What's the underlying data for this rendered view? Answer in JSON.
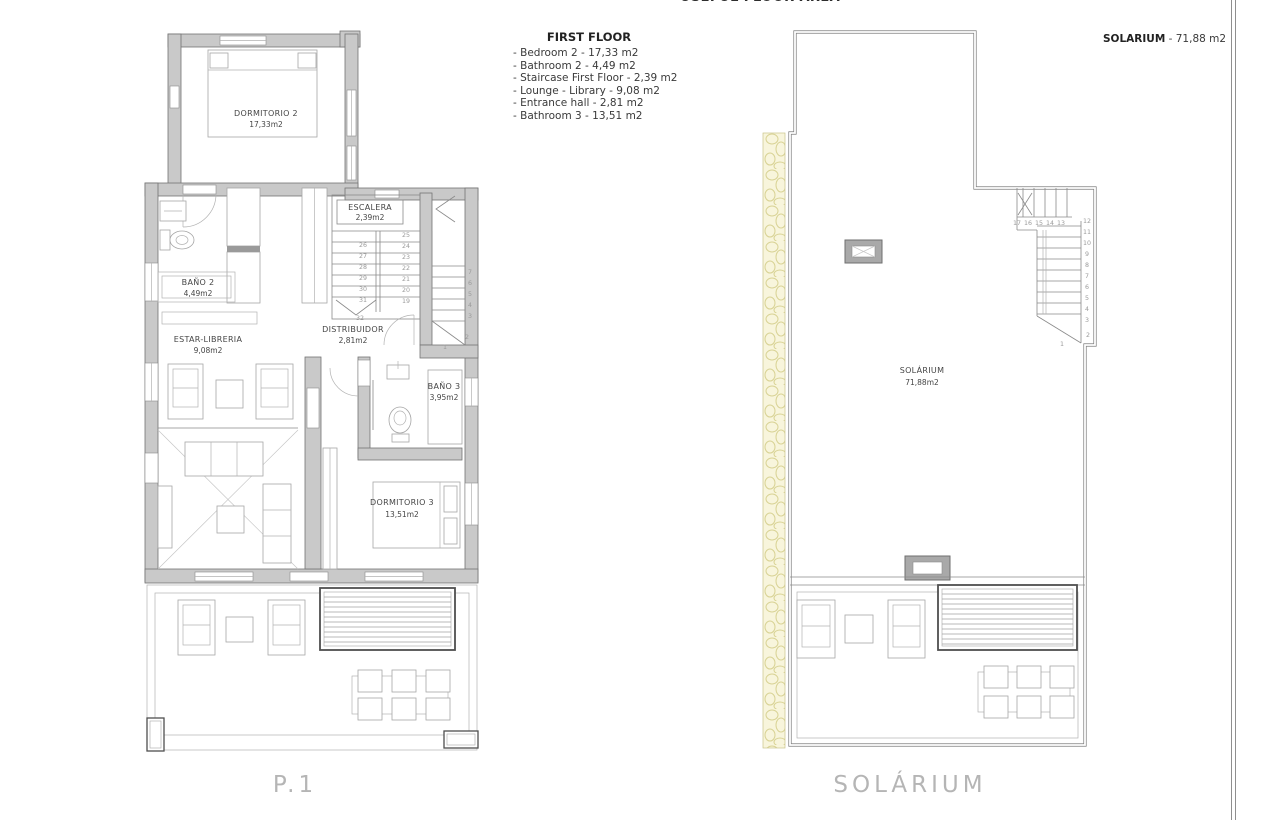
{
  "header": {
    "title": "USEFUL FLOOR AREA"
  },
  "legend": {
    "title": "FIRST FLOOR",
    "items": [
      "- Bedroom 2 - 17,33 m2",
      "- Bathroom 2 - 4,49 m2",
      "- Staircase First Floor - 2,39 m2",
      "- Lounge - Library - 9,08 m2",
      "- Entrance hall - 2,81 m2",
      "- Bathroom 3 - 13,51 m2"
    ],
    "solarium_label": "SOLARIUM",
    "solarium_value": " - 71,88 m2"
  },
  "p1": {
    "caption": "P.1",
    "rooms": {
      "dormitorio2": {
        "name": "DORMITORIO 2",
        "area": "17,33m2"
      },
      "bano2": {
        "name": "BAÑO 2",
        "area": "4,49m2"
      },
      "escalera": {
        "name": "ESCALERA",
        "area": "2,39m2"
      },
      "distribuidor": {
        "name": "DISTRIBUIDOR",
        "area": "2,81m2"
      },
      "estar": {
        "name": "ESTAR-LIBRERIA",
        "area": "9,08m2"
      },
      "bano3": {
        "name": "BAÑO 3",
        "area": "3,95m2"
      },
      "dormitorio3": {
        "name": "DORMITORIO 3",
        "area": "13,51m2"
      }
    },
    "stairs": {
      "left_column": [
        26,
        27,
        28,
        29,
        30,
        31
      ],
      "right_column": [
        25,
        24,
        23,
        22,
        21,
        20,
        19
      ],
      "bottom_step": 32,
      "side_flight": [
        7,
        6,
        5,
        4,
        3
      ],
      "side_flight_lower": [
        2,
        1
      ]
    }
  },
  "solarium": {
    "caption": "SOLÁRIUM",
    "room": {
      "name": "SOLÁRIUM",
      "area": "71,88m2"
    },
    "stairs": {
      "top_row": [
        17,
        16,
        15,
        14,
        13
      ],
      "right_column": [
        12,
        11,
        10,
        9,
        8,
        7,
        6,
        5,
        4,
        3
      ],
      "lower": [
        2,
        1
      ]
    }
  }
}
